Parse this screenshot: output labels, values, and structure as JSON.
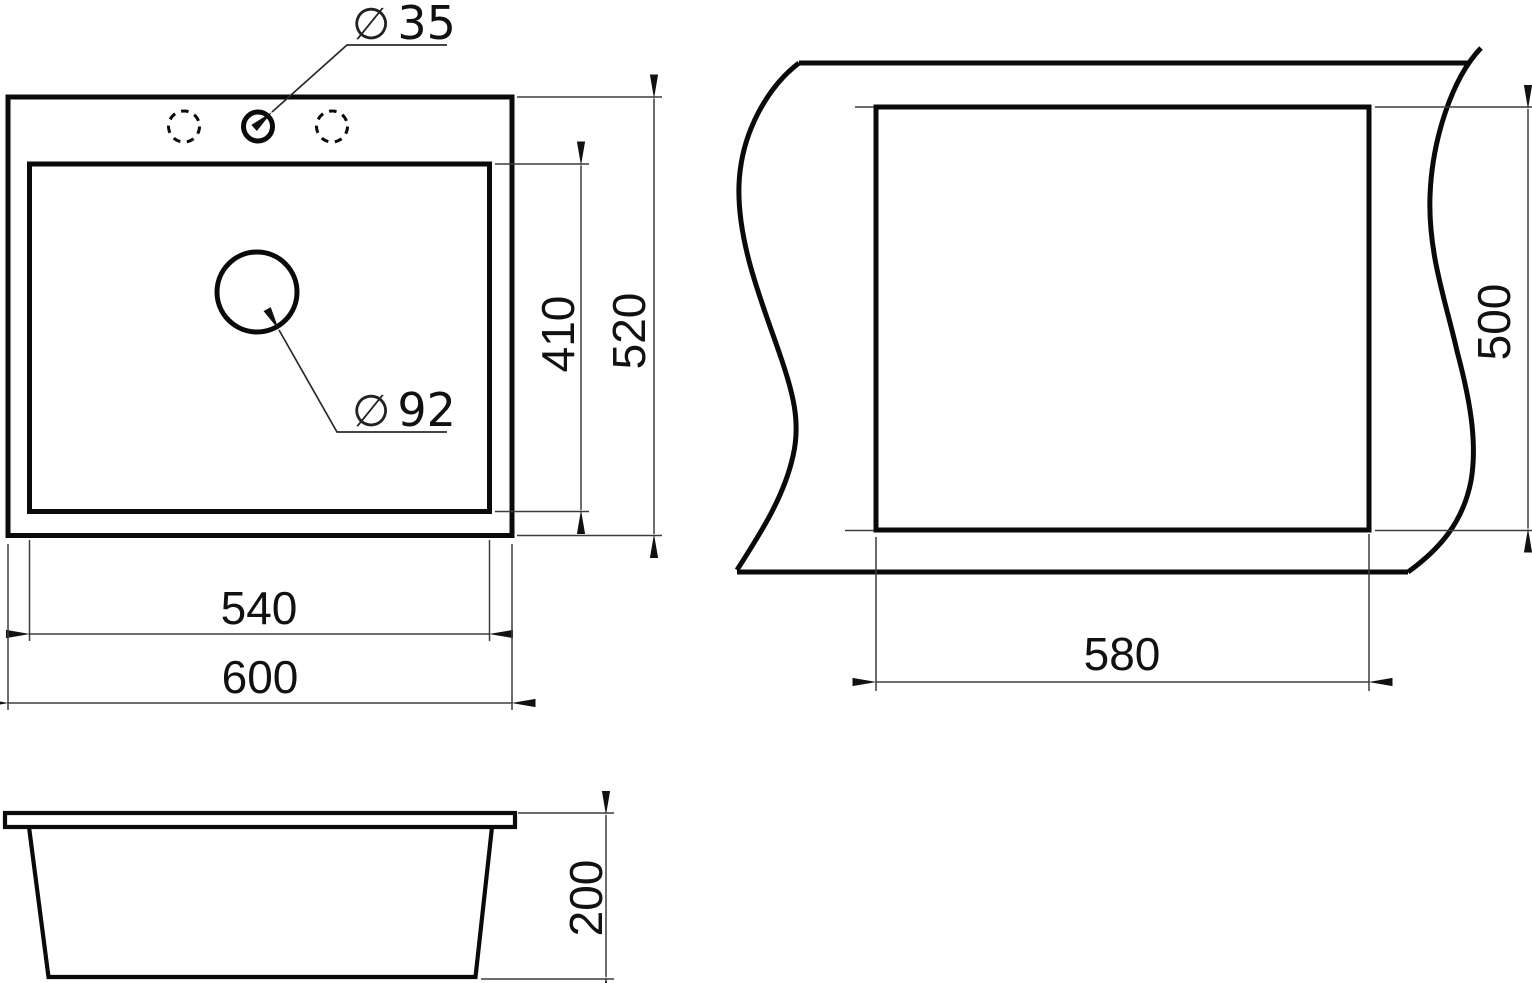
{
  "document": {
    "type": "technical drawing",
    "subject": "kitchen sink installation dimensions"
  },
  "colors": {
    "background": "#ffffff",
    "outline": "#0a0a0a",
    "dim_line": "#3d3d3d",
    "text": "#111111"
  },
  "top_view": {
    "outer_width": "600",
    "inner_width": "540",
    "outer_depth": "520",
    "inner_depth": "410",
    "faucet_hole": {
      "symbol": "∅",
      "value": "35"
    },
    "drain_hole": {
      "symbol": "∅",
      "value": "92"
    }
  },
  "cutout_view": {
    "cut_width": "580",
    "cut_depth": "500"
  },
  "side_view": {
    "height": "200"
  }
}
